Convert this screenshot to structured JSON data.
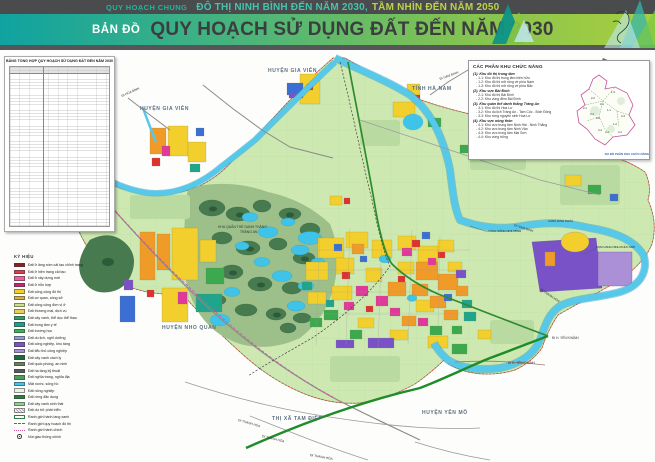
{
  "header": {
    "kicker": "QUY HOẠCH CHUNG",
    "title_teal": "ĐÔ THỊ NINH BÌNH ĐẾN NĂM 2030,",
    "title_green": "TẦM NHÌN ĐẾN NĂM 2050",
    "map_word": "BẢN ĐỒ",
    "main_title": "QUY HOẠCH SỬ DỤNG ĐẤT ĐẾN NĂM 2030",
    "accent_teal": "#1fb5a0",
    "accent_green": "#a8ce3e"
  },
  "table": {
    "title": "BẢNG TỔNG HỢP QUY HOẠCH SỬ DỤNG ĐẤT ĐẾN NĂM 2030"
  },
  "legend": {
    "title": "KÝ HIỆU",
    "items": [
      {
        "type": "fill",
        "color": "#8e1f1f",
        "label": "Đất ở làng xóm cải tạo chỉnh trang"
      },
      {
        "type": "fill",
        "color": "#e23a52",
        "label": "Đất ở hiện trạng cải tạo"
      },
      {
        "type": "fill",
        "color": "#f0609a",
        "label": "Đất ở xây dựng mới"
      },
      {
        "type": "fill",
        "color": "#c2257a",
        "label": "Đất ở hỗn hợp"
      },
      {
        "type": "fill",
        "color": "#f2d024",
        "label": "Đất công cộng đô thị"
      },
      {
        "type": "fill",
        "color": "#d8b23a",
        "label": "Đất cơ quan, công sở"
      },
      {
        "type": "fill",
        "color": "#cfe08a",
        "label": "Đất công cộng đơn vị ở"
      },
      {
        "type": "fill",
        "color": "#e6cf52",
        "label": "Đất thương mại, dịch vụ"
      },
      {
        "type": "fill",
        "color": "#2f9e62",
        "label": "Đất cây xanh, thể dục thể thao"
      },
      {
        "type": "fill",
        "color": "#17a08c",
        "label": "Đất trung tâm y tế"
      },
      {
        "type": "fill",
        "color": "#39b54a",
        "label": "Đất trường học"
      },
      {
        "type": "fill",
        "color": "#8d9ed6",
        "label": "Đất du lịch, nghỉ dưỡng"
      },
      {
        "type": "fill",
        "color": "#7a52c8",
        "label": "Đất công nghiệp, kho tàng"
      },
      {
        "type": "fill",
        "color": "#ab90d8",
        "label": "Đất tiểu thủ công nghiệp"
      },
      {
        "type": "fill",
        "color": "#1d6b3a",
        "label": "Đất cây xanh cách ly"
      },
      {
        "type": "fill",
        "color": "#6e7d5c",
        "label": "Đất quốc phòng, an ninh"
      },
      {
        "type": "fill",
        "color": "#595959",
        "label": "Đất hạ tầng kỹ thuật"
      },
      {
        "type": "fill",
        "color": "#4a9e5a",
        "label": "Đất nghĩa trang, nghĩa địa"
      },
      {
        "type": "fill",
        "color": "#3cc6ee",
        "label": "Mặt nước, sông hồ"
      },
      {
        "type": "fill",
        "color": "#eaf4e2",
        "label": "Đất nông nghiệp"
      },
      {
        "type": "fill",
        "color": "#2e7d44",
        "label": "Đất rừng đặc dụng"
      },
      {
        "type": "fill",
        "color": "#8fd08f",
        "label": "Đất cây xanh sinh thái"
      },
      {
        "type": "hatch",
        "color": "#8a8a8a",
        "label": "Đất dự trữ phát triển"
      },
      {
        "type": "outline",
        "color": "#2e7d44",
        "label": "Ranh giới hành lang xanh"
      },
      {
        "type": "dash",
        "color": "#e03131",
        "label": "Ranh giới quy hoạch đô thị"
      },
      {
        "type": "dot",
        "color": "#d4559e",
        "label": "Ranh giới hành chính"
      },
      {
        "type": "junction",
        "color": "#444444",
        "label": "Nút giao thông chính"
      }
    ]
  },
  "zones_box": {
    "title": "CÁC PHÂN KHU CHỨC NĂNG",
    "caption": "SƠ ĐỒ PHÂN KHU CHỨC NĂNG",
    "groups": [
      {
        "heading": "(1). Khu đô thị trung tâm",
        "items": [
          "- 1-1: Khu đô thị trung tâm hiện hữu",
          "- 1-2: Khu đô thị mở rộng về phía Nam",
          "- 1-3: Khu đô thị mở rộng về phía Bắc"
        ]
      },
      {
        "heading": "(2). Khu vực Bái Đính",
        "items": [
          "- 2-1: Khu đô thị Bái Đính",
          "- 2-2: Khu vùng đệm Bái Đính"
        ]
      },
      {
        "heading": "(3). Khu quần thể danh thắng Tràng An",
        "items": [
          "- 3-1: Khu đô thị Hoa Lư",
          "- 3-2: Khu du lịch Tràng An - Tam Cốc - Bích Động",
          "- 3-3: Khu rừng nguyên sinh Hoa Lư"
        ]
      },
      {
        "heading": "(4). Khu vực nông thôn",
        "items": [
          "- 4-1: Khu vực trung tâm Ninh Hải - Ninh Thắng",
          "- 4-2: Khu vực trung tâm Ninh Vân",
          "- 4-3: Khu vực trung tâm Mai Sơn",
          "- 4-4: Khu vùng trũng"
        ]
      }
    ],
    "minimap_ids": [
      "1-1",
      "1-2",
      "1-3",
      "2-1",
      "2-2",
      "3-1",
      "3-2",
      "3-3",
      "4-1",
      "4-2",
      "4-3",
      "4-4"
    ]
  },
  "map": {
    "labels": {
      "huyen_gia_vien_w": "HUYỆN GIA VIỄN",
      "huyen_gia_vien_n": "HUYỆN GIA VIỄN",
      "tinh_ha_nam": "TỈNH HÀ NAM",
      "huyen_nho_quan": "HUYỆN NHO QUAN",
      "huyen_yen_mo": "HUYỆN YÊN MÔ",
      "thi_xa_tam_diep": "THỊ XÃ TAM ĐIỆP",
      "trang_an_1": "KHU QUẦN THỂ DANH THẮNG",
      "trang_an_2": "TRÀNG AN",
      "di_hoa_binh": "ĐI HÒA BÌNH",
      "di_nam_dinh_1": "ĐI NAM ĐỊNH",
      "di_nam_dinh_2": "ĐI NAM ĐỊNH",
      "di_thanh_hoa_1": "ĐI THANH HÓA",
      "di_thanh_hoa_2": "ĐI THANH HÓA",
      "di_thanh_hoa_3": "ĐI THANH HÓA",
      "di_thanh_hoa_4": "ĐI THANH HÓA",
      "di_yen_khanh_1": "ĐI H. YÊN KHÁNH",
      "di_yen_khanh_2": "ĐI H. YÊN KHÁNH",
      "cang_ninh_phuc": "CẢNG NINH PHÚC",
      "cum_cang_ninh_phuc_moi": "CỤM CẢNG NINH PHÚC MỚI",
      "cang_song_ninh_binh": "CẢNG SÔNG NINH BÌNH"
    }
  }
}
